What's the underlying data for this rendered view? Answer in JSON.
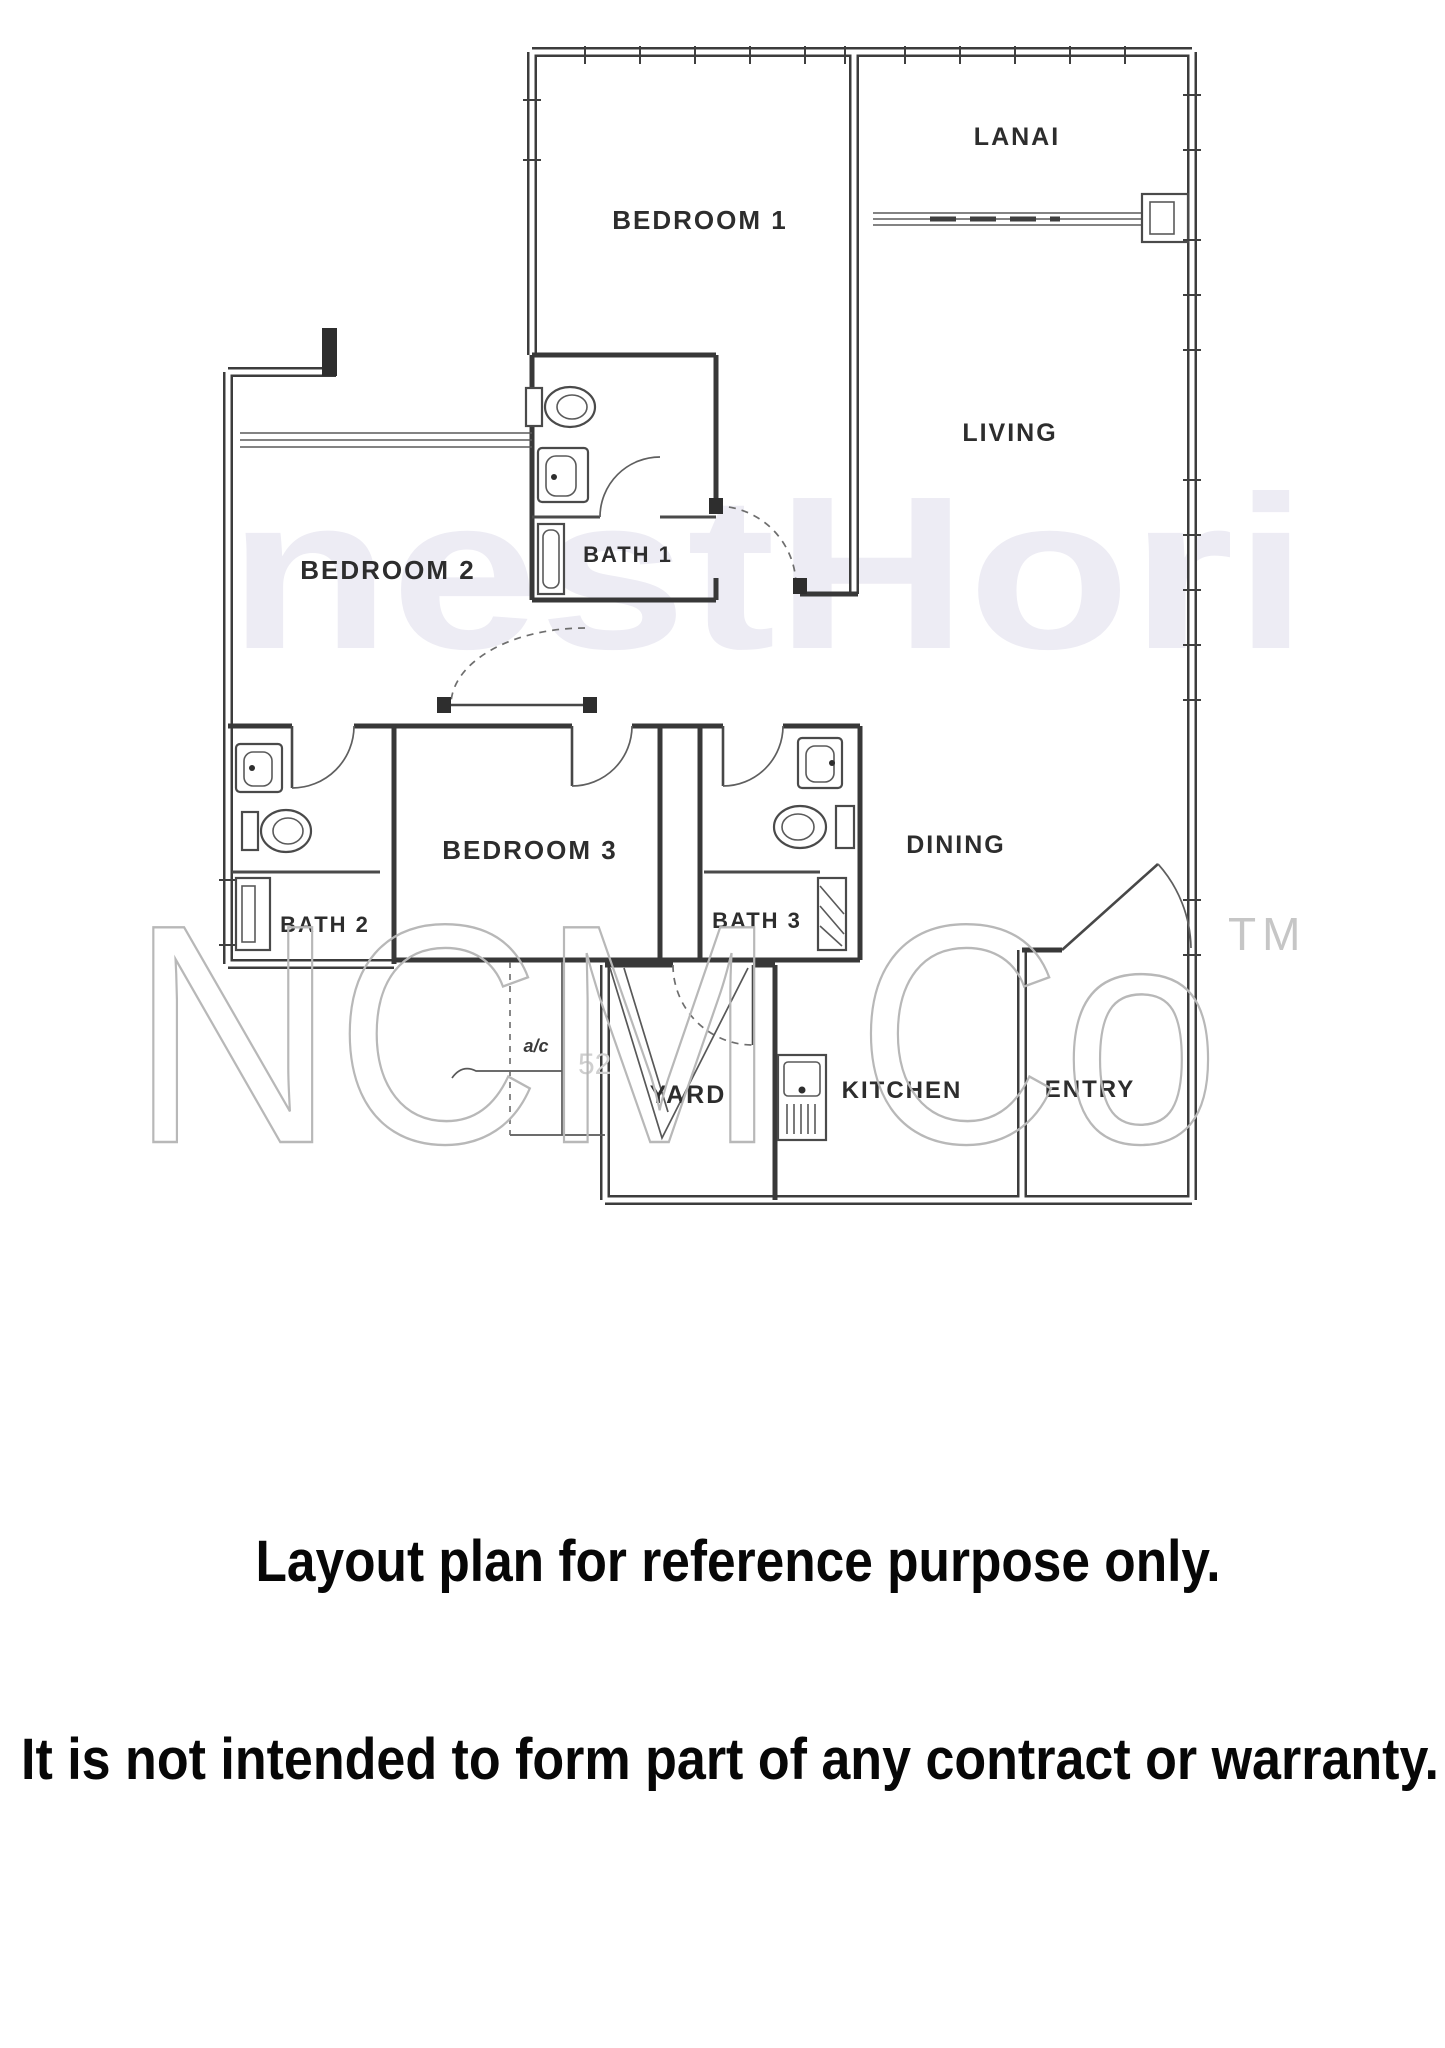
{
  "document": {
    "type": "apartment floor plan scan"
  },
  "floorplan": {
    "rooms": [
      {
        "id": "bedroom-1",
        "label": "BEDROOM 1"
      },
      {
        "id": "lanai",
        "label": "LANAI"
      },
      {
        "id": "living",
        "label": "LIVING"
      },
      {
        "id": "bedroom-2",
        "label": "BEDROOM 2"
      },
      {
        "id": "bath-1",
        "label": "BATH 1"
      },
      {
        "id": "bedroom-3",
        "label": "BEDROOM 3"
      },
      {
        "id": "bath-2",
        "label": "BATH 2"
      },
      {
        "id": "bath-3",
        "label": "BATH 3"
      },
      {
        "id": "dining",
        "label": "DINING"
      },
      {
        "id": "yard",
        "label": "YARD"
      },
      {
        "id": "kitchen",
        "label": "KITCHEN"
      },
      {
        "id": "entry",
        "label": "ENTRY"
      }
    ],
    "ac_label": "a/c"
  },
  "watermarks": {
    "background_text": "nestHori",
    "brand": "NCM Co",
    "trademark": "TM",
    "faint_number": "52"
  },
  "captions": {
    "line1": "Layout plan for reference purpose only.",
    "line2": "It is not intended to form part of any contract or warranty."
  },
  "colors": {
    "wall": "#3c3c3c",
    "label": "#2d2d2d",
    "background_watermark": "#edecf4",
    "brand_watermark": "#b8b8b8",
    "caption": "#070707",
    "paper": "#ffffff"
  }
}
